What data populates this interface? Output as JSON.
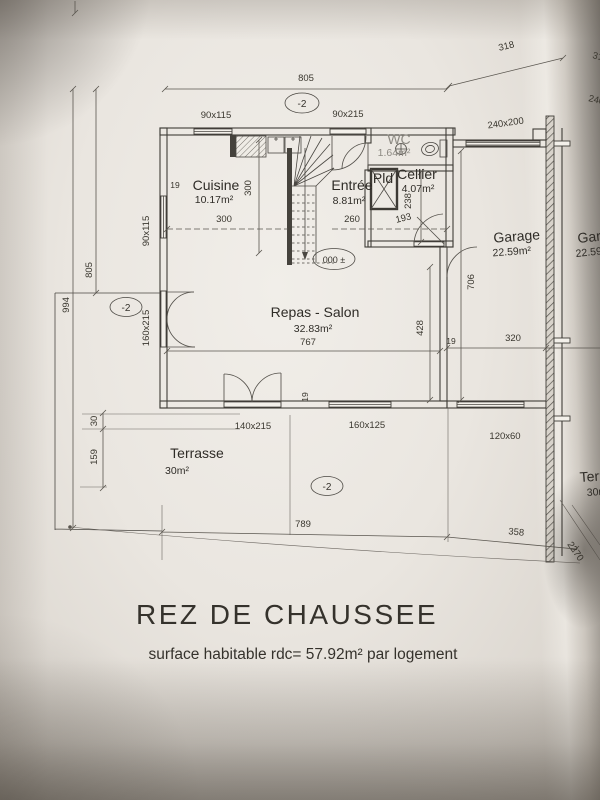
{
  "title": {
    "main": "REZ DE CHAUSSEE",
    "subtitle": "surface habitable rdc= 57.92m² par logement"
  },
  "rooms": {
    "cuisine": {
      "name": "Cuisine",
      "area": "10.17m²"
    },
    "entree": {
      "name": "Entrée",
      "area": "8.81m²"
    },
    "wc": {
      "name": "WC",
      "area": "1.64m²"
    },
    "pld": {
      "name": "Pld"
    },
    "cellier": {
      "name": "Cellier",
      "area": "4.07m²"
    },
    "garage": {
      "name": "Garage",
      "area": "22.59m²"
    },
    "repas_salon": {
      "name": "Repas - Salon",
      "area": "32.83m²"
    },
    "terrasse": {
      "name": "Terrasse",
      "area": "30m²"
    }
  },
  "levels": {
    "ground": "000 ±",
    "minus_two": "-2"
  },
  "dimensions": {
    "top_width": "805",
    "top_right": "318",
    "left_height": "805",
    "left_total": "994",
    "kitchen_width": "300",
    "kitchen_depth": "300",
    "entree_width": "260",
    "cellier_depth_a": "238",
    "cellier_depth_b": "193",
    "garage_depth": "706",
    "garage_width": "320",
    "salon_width": "767",
    "salon_depth": "428",
    "terrace_step": "30",
    "terrace_side": "159",
    "bottom_width": "789",
    "bottom_right": "358",
    "right_total": "2270",
    "wall_19": "19"
  },
  "openings": {
    "kitchen_window": "90x115",
    "entry_door": "90x215",
    "left_window": "90x115",
    "left_door": "160x215",
    "garage_door": "240x200",
    "terrace_door": "140x215",
    "salon_window": "160x125",
    "garage_window": "120x60"
  },
  "adjacent_unit": {
    "garage_name": "Garage",
    "garage_area": "22.59m²",
    "terrasse_name": "Terrasse",
    "terrasse_area": "30m²",
    "garage_door": "240x200",
    "top_dim": "318"
  }
}
